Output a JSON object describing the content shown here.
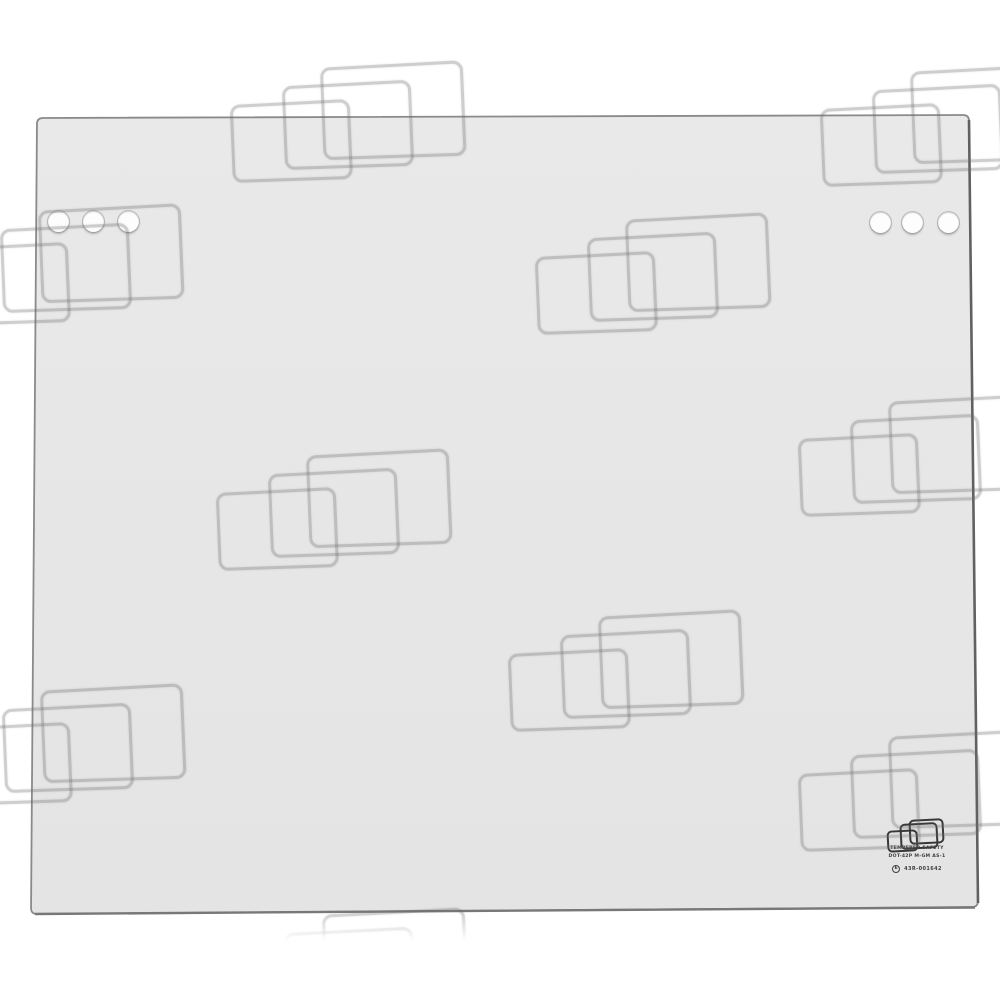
{
  "page": {
    "background": "#ffffff",
    "description": "Product photo of a tempered safety glass cab window panel with mounting holes, certification stamp and repeated watermark logo overlay"
  },
  "glass_panel": {
    "fill_top": "#e9e9e9",
    "fill_bottom": "#e4e4e4",
    "edge_color": "#8a8a8a",
    "right_edge_color": "#616161",
    "bottom_edge_color": "#787878",
    "corners": {
      "top_left": [
        37,
        118
      ],
      "top_right": [
        969,
        115
      ],
      "bottom_right": [
        978,
        907
      ],
      "bottom_left": [
        31,
        914
      ]
    },
    "holes": {
      "diameter": 21,
      "left_group_centers": [
        [
          58,
          221
        ],
        [
          93,
          221
        ],
        [
          128,
          221
        ]
      ],
      "right_group_centers": [
        [
          880,
          222
        ],
        [
          912,
          222
        ],
        [
          948,
          222
        ]
      ]
    }
  },
  "stamp": {
    "logo_color": "#383838",
    "text_color": "#3f3f3f",
    "line1": "TEMPERED SAFETY",
    "line2": "DOT-42P M-GM AS-1",
    "e_mark": "E",
    "code": "43R-001642"
  },
  "watermark": {
    "stroke": "rgba(105,105,105,0.33)",
    "rects": [
      {
        "x": 0,
        "y": 38,
        "w": 115,
        "h": 73
      },
      {
        "x": 52,
        "y": 19,
        "w": 124,
        "h": 79
      },
      {
        "x": 90,
        "y": 0,
        "w": 138,
        "h": 88
      }
    ],
    "clusters": [
      {
        "x": 230,
        "y": 64
      },
      {
        "x": 820,
        "y": 68
      },
      {
        "x": -52,
        "y": 207
      },
      {
        "x": 535,
        "y": 216
      },
      {
        "x": 216,
        "y": 452
      },
      {
        "x": 798,
        "y": 398
      },
      {
        "x": 508,
        "y": 613
      },
      {
        "x": -50,
        "y": 687
      },
      {
        "x": 798,
        "y": 733
      },
      {
        "x": 232,
        "y": 911
      }
    ]
  }
}
